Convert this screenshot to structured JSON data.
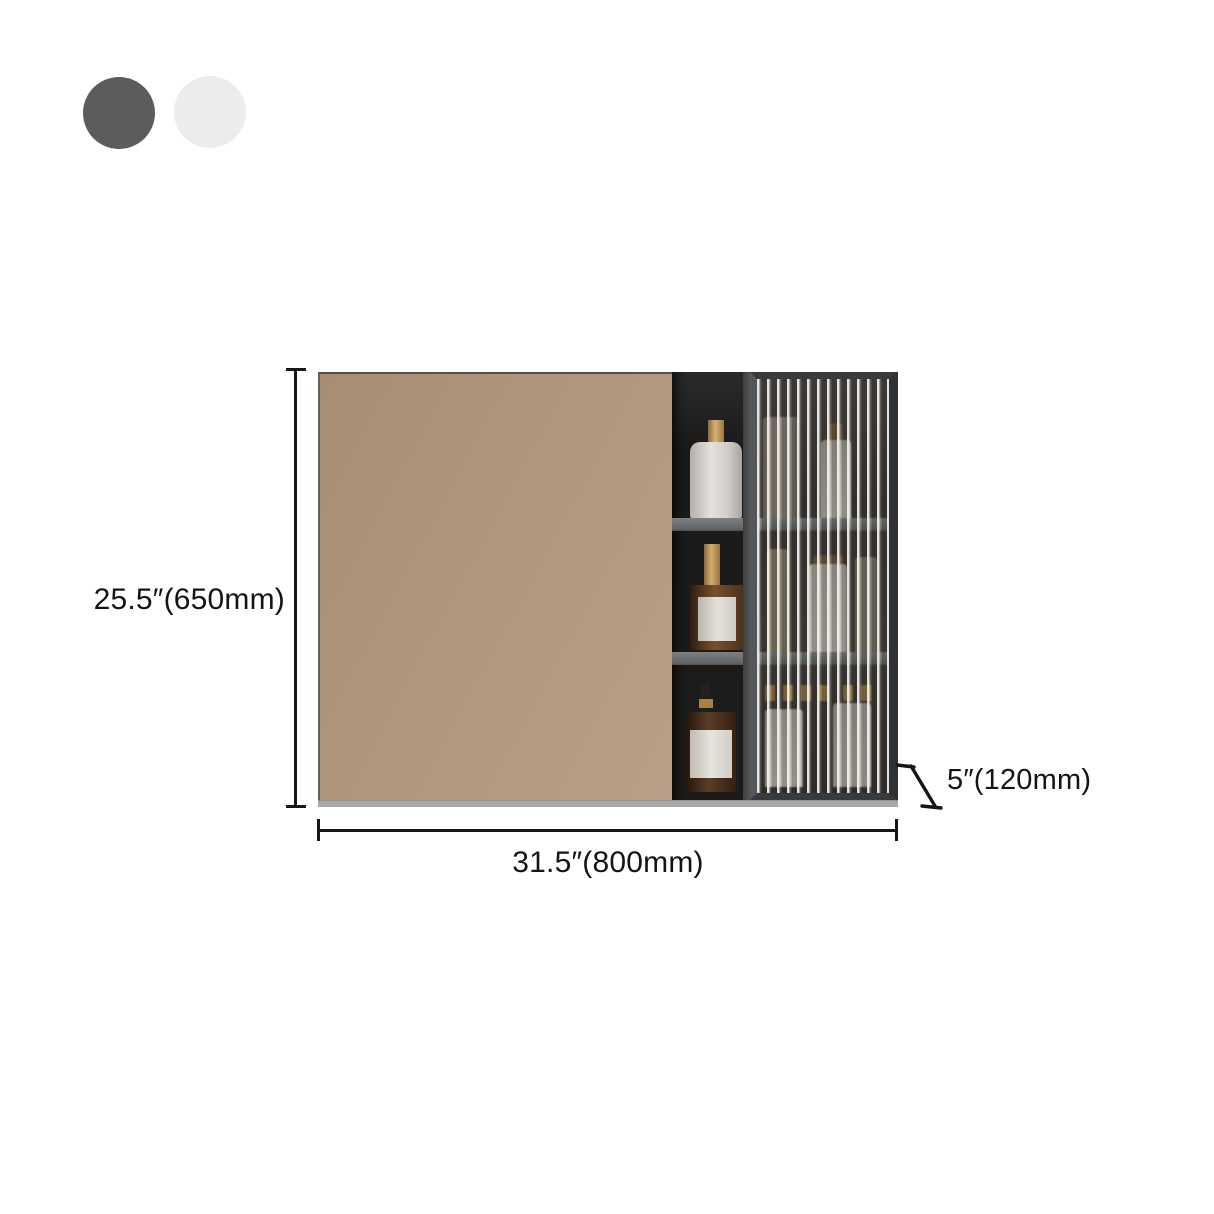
{
  "page": {
    "background": "#ffffff",
    "type": "product-dimension-diagram"
  },
  "color_options": {
    "swatches": [
      {
        "name": "dark-gray",
        "color": "#5d5c5a"
      },
      {
        "name": "white",
        "color": "#ececeb"
      }
    ]
  },
  "product": {
    "name": "mirror-cabinet-with-fluted-glass-door",
    "colors": {
      "mirror_tan": "#b0967c",
      "frame_dark_gray": "#383b3d",
      "shelf_gray": "#6e7174",
      "niche_interior": "#1d1c1b",
      "glass_rib_light": "#eeede9",
      "base_gray": "#a7a7a7",
      "bottle_gold": "#c29a5d",
      "bottle_amber": "#5c3c26",
      "bottle_white": "#e4e2de"
    }
  },
  "dimensions": {
    "height": "25.5″(650mm)",
    "width": "31.5″(800mm)",
    "depth": "5″(120mm)"
  }
}
